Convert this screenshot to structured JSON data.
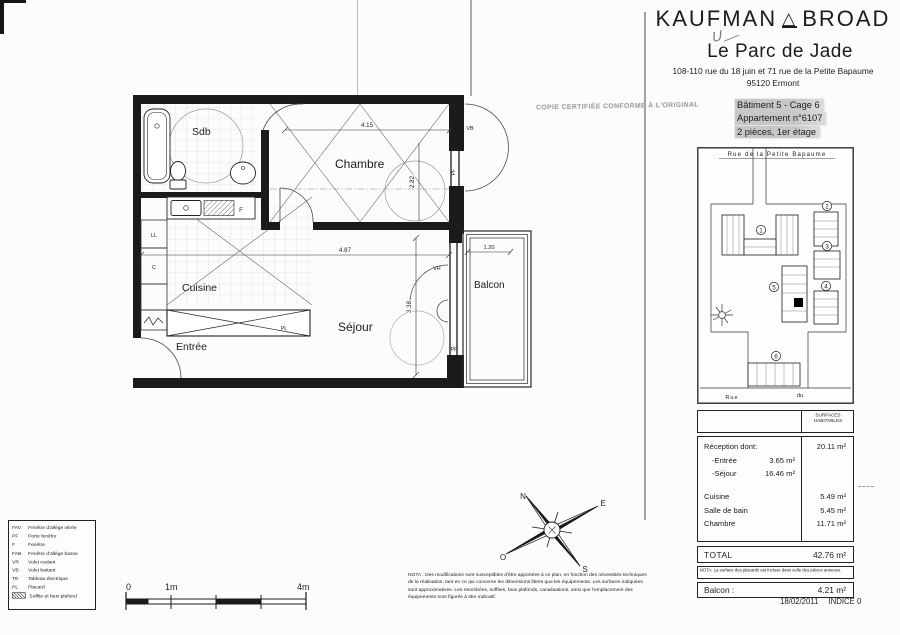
{
  "brand": {
    "left": "KAUFMAN",
    "right": "BROAD"
  },
  "annotations": {
    "handwritten": "U"
  },
  "project": {
    "title": "Le Parc de Jade",
    "address1": "108-110 rue du 18 juin et 71 rue de la Petite Bapaume",
    "address2": "95120 Ermont"
  },
  "stamp": "COPIE CERTIFIÉE CONFORME À L'ORIGINAL",
  "unit": {
    "line1": "Bâtiment 5 - Cage 6",
    "line2": "Appartement n°6107",
    "line3": "2 pièces, 1er étage"
  },
  "site_plan": {
    "street_top": "Rue de la Petite Bapaume",
    "street_bottom_left": "Rue",
    "street_bottom_right": "du",
    "b1": "1",
    "b2": "2",
    "b3": "3",
    "b4": "4",
    "b5": "5",
    "b6": "6"
  },
  "compass": {
    "n": "N",
    "e": "E",
    "s": "S",
    "o": "O"
  },
  "plan": {
    "rooms": {
      "sdb": "Sdb",
      "chambre": "Chambre",
      "cuisine": "Cuisine",
      "entree": "Entrée",
      "sejour": "Séjour",
      "balcon": "Balcon"
    },
    "dims": {
      "chambre_w": "4.15",
      "sejour_w": "4.87",
      "sejour_h": "3.38",
      "chambre_h": "2.82",
      "balcon_w": "1.20"
    },
    "tags": {
      "vb": "VB",
      "pf": "PF",
      "vr": "VR",
      "ll": "LL",
      "c": "C",
      "pl": "PL",
      "f": "F"
    }
  },
  "legend": {
    "items": [
      {
        "abbr": "FAV",
        "label": "Fenêtre d'allège vitrée"
      },
      {
        "abbr": "PF",
        "label": "Porte fenêtre"
      },
      {
        "abbr": "F",
        "label": "Fenêtre"
      },
      {
        "abbr": "FAB",
        "label": "Fenêtre d'allège basse"
      },
      {
        "abbr": "VR",
        "label": "Volet roulant"
      },
      {
        "abbr": "VB",
        "label": "Volet battant"
      },
      {
        "abbr": "TE",
        "label": "Tableau électrique"
      },
      {
        "abbr": "PL",
        "label": "Placard"
      },
      {
        "abbr": "",
        "label": "Soffite et faux plafond"
      }
    ]
  },
  "scale_bar": {
    "t0": "0",
    "t1": "1m",
    "t4": "4m"
  },
  "surface_table": {
    "header": "SURFACES HABITABLES",
    "rows": [
      {
        "label": "Réception dont:",
        "sub": "",
        "value": "20.11 m²"
      },
      {
        "label": "-Entrée",
        "sub": "3.65 m²",
        "value": ""
      },
      {
        "label": "-Séjour",
        "sub": "16.46 m²",
        "value": ""
      },
      {
        "label": "Cuisine",
        "sub": "",
        "value": "5.49 m²"
      },
      {
        "label": "Salle de bain",
        "sub": "",
        "value": "5.45 m²"
      },
      {
        "label": "Chambre",
        "sub": "",
        "value": "11.71 m²"
      }
    ],
    "total_label": "TOTAL",
    "total_value": "42.76 m²",
    "nota": "NOTA: La surface des placards est incluse dans celle des pièces annexes.",
    "balcon_label": "Balcon :",
    "balcon_value": "4.21 m²"
  },
  "footer": {
    "date": "18/02/2011",
    "indice": "INDICE 0"
  },
  "nota_plan": "NOTA : Des modifications sont susceptibles d'être apportées à ce plan, en fonction des nécessités techniques de la réalisation, tant en ce qui concerne les dimensions libres que les équipements. Les surfaces indiquées sont approximatives. Les retombées, soffites, faux plafonds, canalisations, ainsi que l'emplacement des équipements sont figurés à titre indicatif."
}
